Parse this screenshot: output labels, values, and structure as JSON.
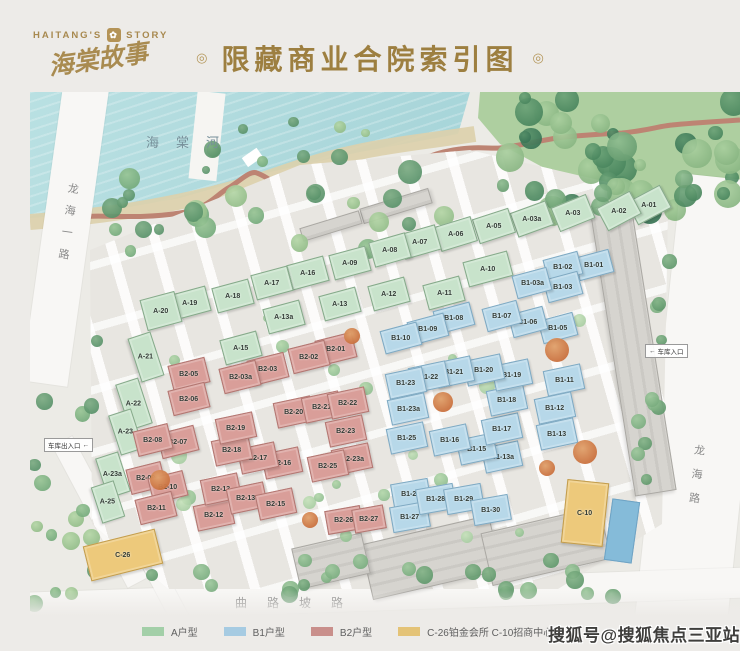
{
  "header": {
    "logo_left": "HAITANG'S",
    "logo_right": "STORY",
    "logo_cn": "海棠故事",
    "title": "限藏商业合院索引图",
    "ornament": "◎"
  },
  "map": {
    "river_label": "海棠河",
    "road_left": "龙海一路",
    "road_right": "龙海路",
    "road_bottom": "曲路坡路",
    "garage_exit_label": "车库出入口",
    "garage_exit_arrow": "←",
    "garage_entry_label": "车库入口",
    "garage_entry_arrow": "←",
    "buildings": [
      {
        "id": "A-01",
        "t": "a",
        "x": 648,
        "y": 204,
        "r": -28
      },
      {
        "id": "A-02",
        "t": "a",
        "x": 618,
        "y": 210,
        "r": -28
      },
      {
        "id": "A-03",
        "t": "a",
        "x": 572,
        "y": 212,
        "r": -22
      },
      {
        "id": "A-03a",
        "t": "a",
        "x": 531,
        "y": 218,
        "r": -20
      },
      {
        "id": "A-05",
        "t": "a",
        "x": 493,
        "y": 225,
        "r": -18
      },
      {
        "id": "A-06",
        "t": "a",
        "x": 455,
        "y": 233,
        "r": -17
      },
      {
        "id": "A-07",
        "t": "a",
        "x": 419,
        "y": 241,
        "r": -16
      },
      {
        "id": "A-08",
        "t": "a",
        "x": 389,
        "y": 249,
        "r": -16
      },
      {
        "id": "A-09",
        "t": "a",
        "x": 349,
        "y": 262,
        "r": -15
      },
      {
        "id": "A-10",
        "t": "a",
        "x": 487,
        "y": 268,
        "r": -15,
        "w": 44,
        "h": 24
      },
      {
        "id": "A-11",
        "t": "a",
        "x": 443,
        "y": 292,
        "r": -15
      },
      {
        "id": "A-12",
        "t": "a",
        "x": 388,
        "y": 293,
        "r": -15
      },
      {
        "id": "A-13",
        "t": "a",
        "x": 339,
        "y": 303,
        "r": -15
      },
      {
        "id": "A-13a",
        "t": "a",
        "x": 283,
        "y": 316,
        "r": -15
      },
      {
        "id": "A-15",
        "t": "a",
        "x": 240,
        "y": 347,
        "r": -15
      },
      {
        "id": "A-16",
        "t": "a",
        "x": 307,
        "y": 272,
        "r": -15
      },
      {
        "id": "A-17",
        "t": "a",
        "x": 271,
        "y": 282,
        "r": -15
      },
      {
        "id": "A-18",
        "t": "a",
        "x": 232,
        "y": 295,
        "r": -15
      },
      {
        "id": "A-19",
        "t": "a",
        "x": 189,
        "y": 302,
        "r": -15
      },
      {
        "id": "A-20",
        "t": "a",
        "x": 160,
        "y": 310,
        "r": -15,
        "w": 34,
        "h": 30
      },
      {
        "id": "A-21",
        "t": "a",
        "x": 145,
        "y": 356,
        "r": 72,
        "w": 44,
        "h": 22
      },
      {
        "id": "A-22",
        "t": "a",
        "x": 133,
        "y": 403,
        "r": 72,
        "w": 46,
        "h": 22
      },
      {
        "id": "A-23",
        "t": "a",
        "x": 125,
        "y": 431,
        "r": 72,
        "w": 40,
        "h": 22
      },
      {
        "id": "A-23a",
        "t": "a",
        "x": 112,
        "y": 474,
        "r": 72,
        "w": 40,
        "h": 22
      },
      {
        "id": "A-25",
        "t": "a",
        "x": 107,
        "y": 501,
        "r": 72,
        "w": 36,
        "h": 22
      },
      {
        "id": "B1-01",
        "t": "b1",
        "x": 593,
        "y": 264,
        "r": -15,
        "w": 34,
        "h": 22
      },
      {
        "id": "B1-02",
        "t": "b1",
        "x": 562,
        "y": 266,
        "r": -15,
        "w": 34,
        "h": 22
      },
      {
        "id": "B1-03",
        "t": "b1",
        "x": 562,
        "y": 286,
        "r": -15,
        "w": 34,
        "h": 22
      },
      {
        "id": "B1-03a",
        "t": "b1",
        "x": 531,
        "y": 282,
        "r": -15,
        "w": 34,
        "h": 22
      },
      {
        "id": "B1-05",
        "t": "b1",
        "x": 557,
        "y": 327,
        "r": -15,
        "w": 34,
        "h": 22
      },
      {
        "id": "B1-06",
        "t": "b1",
        "x": 527,
        "y": 321,
        "r": -15,
        "w": 34,
        "h": 22
      },
      {
        "id": "B1-07",
        "t": "b1",
        "x": 501,
        "y": 315,
        "r": -15,
        "w": 34,
        "h": 22
      },
      {
        "id": "B1-08",
        "t": "b1",
        "x": 453,
        "y": 317,
        "r": -15,
        "w": 36,
        "h": 22
      },
      {
        "id": "B1-09",
        "t": "b1",
        "x": 427,
        "y": 328,
        "r": -15,
        "w": 36,
        "h": 22
      },
      {
        "id": "B1-10",
        "t": "b1",
        "x": 400,
        "y": 337,
        "r": -15,
        "w": 36,
        "h": 22
      },
      {
        "id": "B1-11",
        "t": "b1",
        "x": 563,
        "y": 379,
        "r": -12,
        "w": 36,
        "h": 24
      },
      {
        "id": "B1-12",
        "t": "b1",
        "x": 554,
        "y": 407,
        "r": -12,
        "w": 36,
        "h": 24
      },
      {
        "id": "B1-13",
        "t": "b1",
        "x": 556,
        "y": 433,
        "r": -12,
        "w": 36,
        "h": 24
      },
      {
        "id": "B1-13a",
        "t": "b1",
        "x": 501,
        "y": 456,
        "r": -12
      },
      {
        "id": "B1-15",
        "t": "b1",
        "x": 476,
        "y": 448,
        "r": -12
      },
      {
        "id": "B1-16",
        "t": "b1",
        "x": 449,
        "y": 439,
        "r": -12
      },
      {
        "id": "B1-17",
        "t": "b1",
        "x": 501,
        "y": 428,
        "r": -12
      },
      {
        "id": "B1-18",
        "t": "b1",
        "x": 506,
        "y": 399,
        "r": -12
      },
      {
        "id": "B1-19",
        "t": "b1",
        "x": 511,
        "y": 374,
        "r": -12
      },
      {
        "id": "B1-20",
        "t": "b1",
        "x": 483,
        "y": 369,
        "r": -12
      },
      {
        "id": "B1-21",
        "t": "b1",
        "x": 453,
        "y": 371,
        "r": -12
      },
      {
        "id": "B1-22",
        "t": "b1",
        "x": 428,
        "y": 376,
        "r": -12
      },
      {
        "id": "B1-23",
        "t": "b1",
        "x": 405,
        "y": 382,
        "r": -12
      },
      {
        "id": "B1-23a",
        "t": "b1",
        "x": 407,
        "y": 408,
        "r": -12
      },
      {
        "id": "B1-25",
        "t": "b1",
        "x": 406,
        "y": 437,
        "r": -12
      },
      {
        "id": "B1-26",
        "t": "b1",
        "x": 410,
        "y": 493,
        "r": -10
      },
      {
        "id": "B1-27",
        "t": "b1",
        "x": 409,
        "y": 516,
        "r": -10
      },
      {
        "id": "B1-28",
        "t": "b1",
        "x": 435,
        "y": 498,
        "r": -10
      },
      {
        "id": "B1-29",
        "t": "b1",
        "x": 463,
        "y": 498,
        "r": -10
      },
      {
        "id": "B1-30",
        "t": "b1",
        "x": 490,
        "y": 509,
        "r": -10
      },
      {
        "id": "B2-01",
        "t": "b2",
        "x": 335,
        "y": 348,
        "r": -14
      },
      {
        "id": "B2-02",
        "t": "b2",
        "x": 308,
        "y": 356,
        "r": -14
      },
      {
        "id": "B2-03",
        "t": "b2",
        "x": 267,
        "y": 368,
        "r": -14
      },
      {
        "id": "B2-03a",
        "t": "b2",
        "x": 239,
        "y": 376,
        "r": -14
      },
      {
        "id": "B2-05",
        "t": "b2",
        "x": 188,
        "y": 373,
        "r": -14
      },
      {
        "id": "B2-06",
        "t": "b2",
        "x": 188,
        "y": 398,
        "r": -14
      },
      {
        "id": "B2-07",
        "t": "b2",
        "x": 177,
        "y": 441,
        "r": -14
      },
      {
        "id": "B2-08",
        "t": "b2",
        "x": 152,
        "y": 439,
        "r": -14,
        "w": 34,
        "h": 24
      },
      {
        "id": "B2-09",
        "t": "b2",
        "x": 145,
        "y": 477,
        "r": -14,
        "w": 34,
        "h": 24
      },
      {
        "id": "B2-10",
        "t": "b2",
        "x": 167,
        "y": 486,
        "r": -14,
        "w": 34,
        "h": 24
      },
      {
        "id": "B2-11",
        "t": "b2",
        "x": 155,
        "y": 507,
        "r": -14
      },
      {
        "id": "B2-12",
        "t": "b2",
        "x": 213,
        "y": 514,
        "r": -12
      },
      {
        "id": "B2-13",
        "t": "b2",
        "x": 220,
        "y": 488,
        "r": -12
      },
      {
        "id": "B2-13a",
        "t": "b2",
        "x": 246,
        "y": 497,
        "r": -12
      },
      {
        "id": "B2-15",
        "t": "b2",
        "x": 275,
        "y": 503,
        "r": -12
      },
      {
        "id": "B2-16",
        "t": "b2",
        "x": 281,
        "y": 462,
        "r": -12
      },
      {
        "id": "B2-17",
        "t": "b2",
        "x": 257,
        "y": 457,
        "r": -12
      },
      {
        "id": "B2-18",
        "t": "b2",
        "x": 231,
        "y": 449,
        "r": -12
      },
      {
        "id": "B2-19",
        "t": "b2",
        "x": 235,
        "y": 427,
        "r": -12
      },
      {
        "id": "B2-20",
        "t": "b2",
        "x": 293,
        "y": 411,
        "r": -12
      },
      {
        "id": "B2-21",
        "t": "b2",
        "x": 321,
        "y": 406,
        "r": -12
      },
      {
        "id": "B2-22",
        "t": "b2",
        "x": 347,
        "y": 402,
        "r": -12
      },
      {
        "id": "B2-23",
        "t": "b2",
        "x": 345,
        "y": 430,
        "r": -12
      },
      {
        "id": "B2-23a",
        "t": "b2",
        "x": 351,
        "y": 458,
        "r": -12
      },
      {
        "id": "B2-25",
        "t": "b2",
        "x": 327,
        "y": 465,
        "r": -12
      },
      {
        "id": "B2-26",
        "t": "b2",
        "x": 343,
        "y": 519,
        "r": -10,
        "w": 34,
        "h": 22
      },
      {
        "id": "B2-27",
        "t": "b2",
        "x": 368,
        "y": 518,
        "r": -10,
        "w": 30,
        "h": 22
      },
      {
        "id": "C-10",
        "t": "c",
        "x": 584,
        "y": 512,
        "r": 6,
        "w": 40,
        "h": 62
      },
      {
        "id": "C-26",
        "t": "c",
        "x": 122,
        "y": 554,
        "r": -14,
        "w": 72,
        "h": 34
      }
    ]
  },
  "legend": {
    "items": [
      {
        "label": "A户型",
        "color": "#a3cfa8"
      },
      {
        "label": "B1户型",
        "color": "#a6cbe2"
      },
      {
        "label": "B2户型",
        "color": "#c98f8b"
      },
      {
        "label": "C-26铂金会所  C-10招商中心",
        "color": "#e4c377"
      }
    ]
  },
  "watermark": "搜狐号@搜狐焦点三亚站",
  "colors": {
    "title_gold": "#9d7f40",
    "water": "#a9d6da",
    "type_a_fill": "#c8e3cb",
    "type_b1_fill": "#b7d8e9",
    "type_b2_fill": "#d99e99",
    "type_c_fill": "#edc97b"
  }
}
